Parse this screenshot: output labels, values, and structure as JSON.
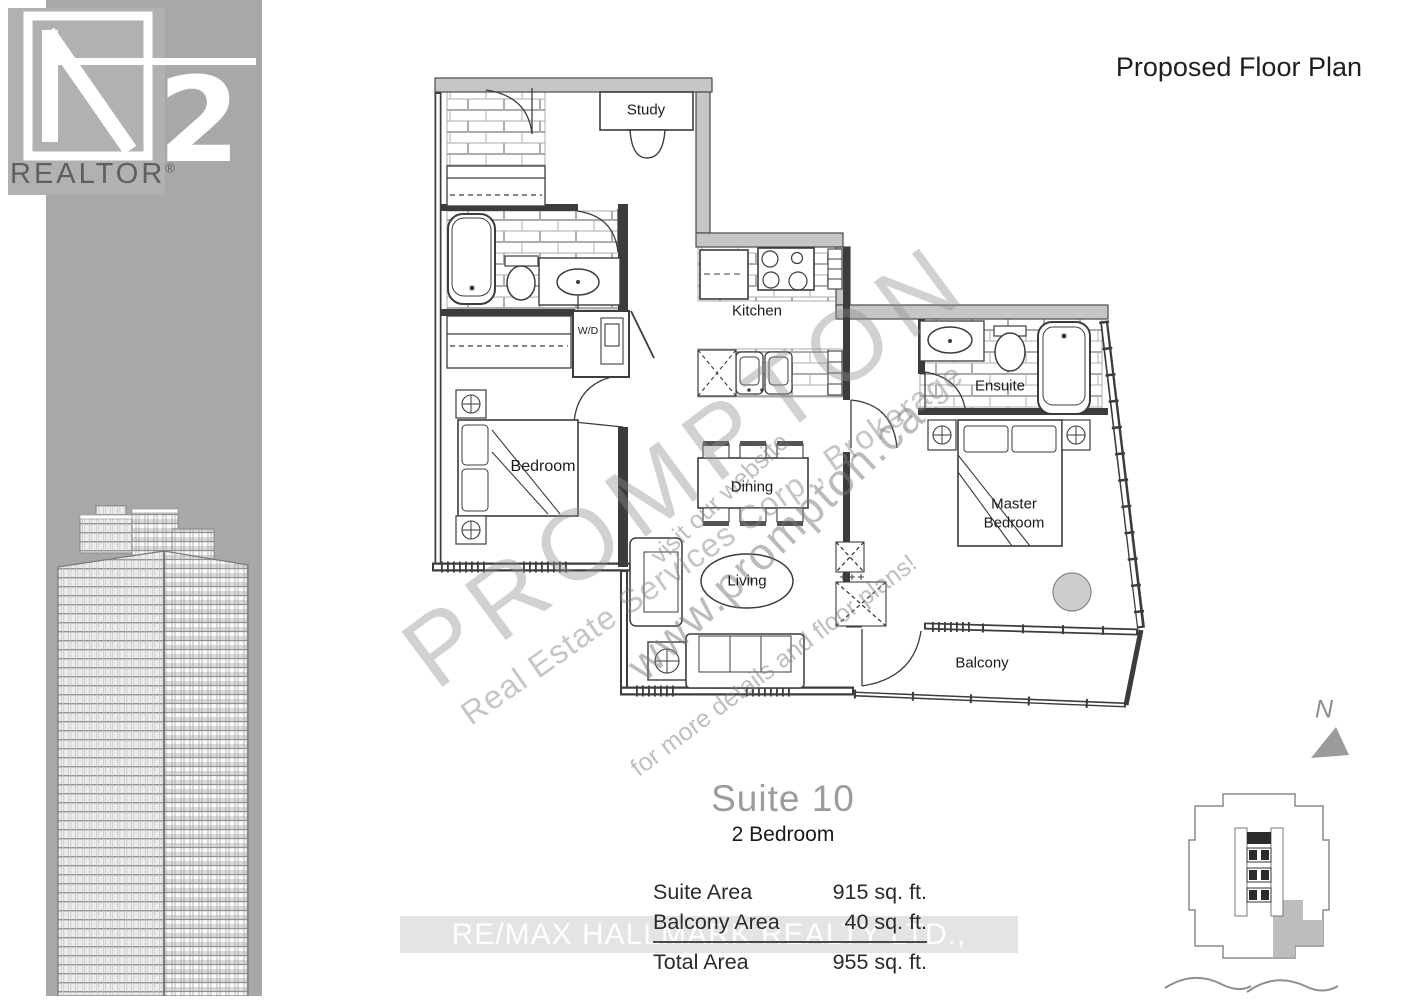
{
  "header": {
    "title": "Proposed Floor Plan"
  },
  "logo": {
    "digit": "2",
    "subtext": "REALTOR",
    "registered": "®"
  },
  "floorplan": {
    "rooms": [
      {
        "label": "Study"
      },
      {
        "label": "Kitchen"
      },
      {
        "label": "W/D"
      },
      {
        "label": "Bedroom"
      },
      {
        "label": "Dining"
      },
      {
        "label": "Living"
      },
      {
        "label": "Ensuite"
      },
      {
        "label": "Master Bedroom"
      },
      {
        "label": "Balcony"
      }
    ]
  },
  "watermarks": {
    "brand": "PROMPTON",
    "brand_sub": "Real Estate Services Corp., Brokerage",
    "visit": "visit our website",
    "url": "www.prompton.ca",
    "details": "for more details and floor plans!",
    "listing_brokerage": "RE/MAX HALLMARK REALTY LTD., Brokerage"
  },
  "suite": {
    "name": "Suite 10",
    "type": "2 Bedroom",
    "rows": [
      {
        "label": "Suite Area",
        "value": "915 sq. ft."
      },
      {
        "label": "Balcony Area",
        "value": "40 sq. ft."
      }
    ],
    "total_row": {
      "label": "Total Area",
      "value": "955 sq. ft."
    }
  },
  "compass": {
    "north": "N"
  },
  "colors": {
    "band_gray": "#a8a8a8",
    "wall_gray": "#c6c6c6",
    "suite_shade": "#bdbdbd"
  }
}
